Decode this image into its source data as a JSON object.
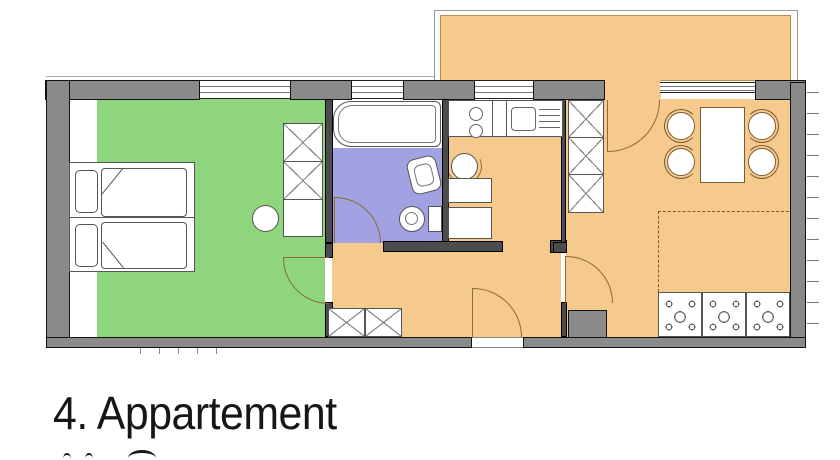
{
  "title": {
    "text": "4. Appartement"
  },
  "plan": {
    "type": "apartment-floor-plan",
    "rooms": [
      {
        "id": "bedroom",
        "fill": "#8ed57e"
      },
      {
        "id": "bathroom",
        "fill": "#a2a2e2"
      },
      {
        "id": "hall",
        "fill": "#f6c98c"
      },
      {
        "id": "kitchen",
        "fill": "#f6c98c"
      },
      {
        "id": "living",
        "fill": "#f6c98c"
      },
      {
        "id": "balcony",
        "fill": "#f6c98c"
      }
    ]
  },
  "colors": {
    "bedroom": "#8ed57e",
    "bathroom": "#a2a2e2",
    "orange": "#f6c98c",
    "wall_outer": "#8a8a8a",
    "wall_inner": "#4c4c4c",
    "text": "#161616"
  }
}
